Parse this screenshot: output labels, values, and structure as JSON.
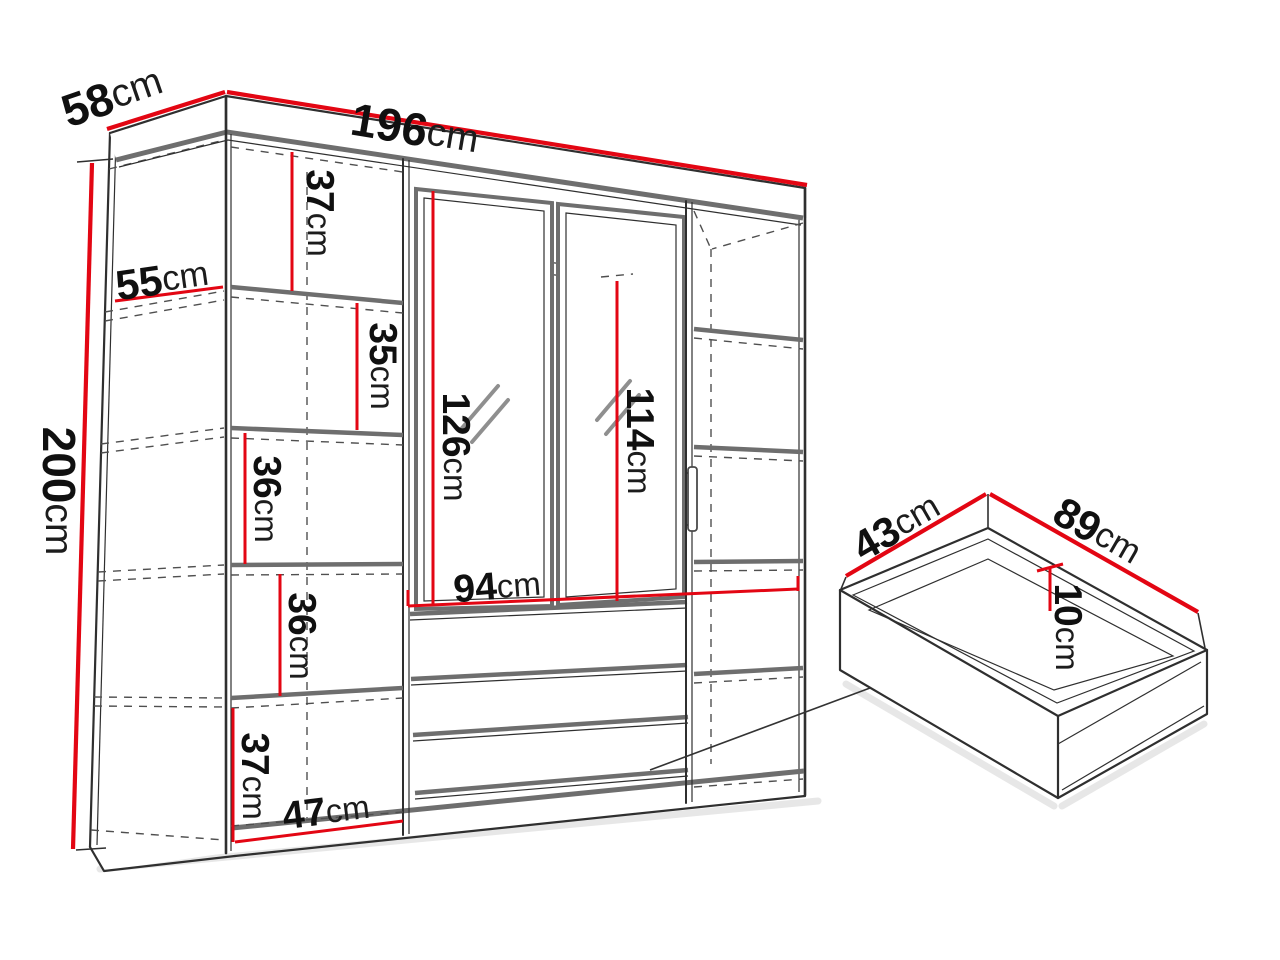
{
  "colors": {
    "dimension_red": "#e30613",
    "line_dark": "#2f2f2f",
    "line_gray": "#6e6e6e",
    "dashed_gray": "#4f4f4f",
    "shadow_gray": "#dadada",
    "background": "#ffffff"
  },
  "wardrobe": {
    "width": {
      "num": "196",
      "unit": "cm"
    },
    "depth": {
      "num": "58",
      "unit": "cm"
    },
    "height": {
      "num": "200",
      "unit": "cm"
    },
    "interior_depth": {
      "num": "55",
      "unit": "cm"
    },
    "shelf_column": {
      "width": {
        "num": "47",
        "unit": "cm"
      },
      "compartment_heights": [
        {
          "num": "37",
          "unit": "cm"
        },
        {
          "num": "35",
          "unit": "cm"
        },
        {
          "num": "36",
          "unit": "cm"
        },
        {
          "num": "36",
          "unit": "cm"
        },
        {
          "num": "37",
          "unit": "cm"
        }
      ]
    },
    "mirror_section": {
      "width": {
        "num": "94",
        "unit": "cm"
      },
      "left_mirror_height": {
        "num": "126",
        "unit": "cm"
      },
      "right_mirror_height": {
        "num": "114",
        "unit": "cm"
      }
    }
  },
  "drawer_detail": {
    "depth": {
      "num": "43",
      "unit": "cm"
    },
    "width": {
      "num": "89",
      "unit": "cm"
    },
    "height": {
      "num": "10",
      "unit": "cm"
    }
  }
}
